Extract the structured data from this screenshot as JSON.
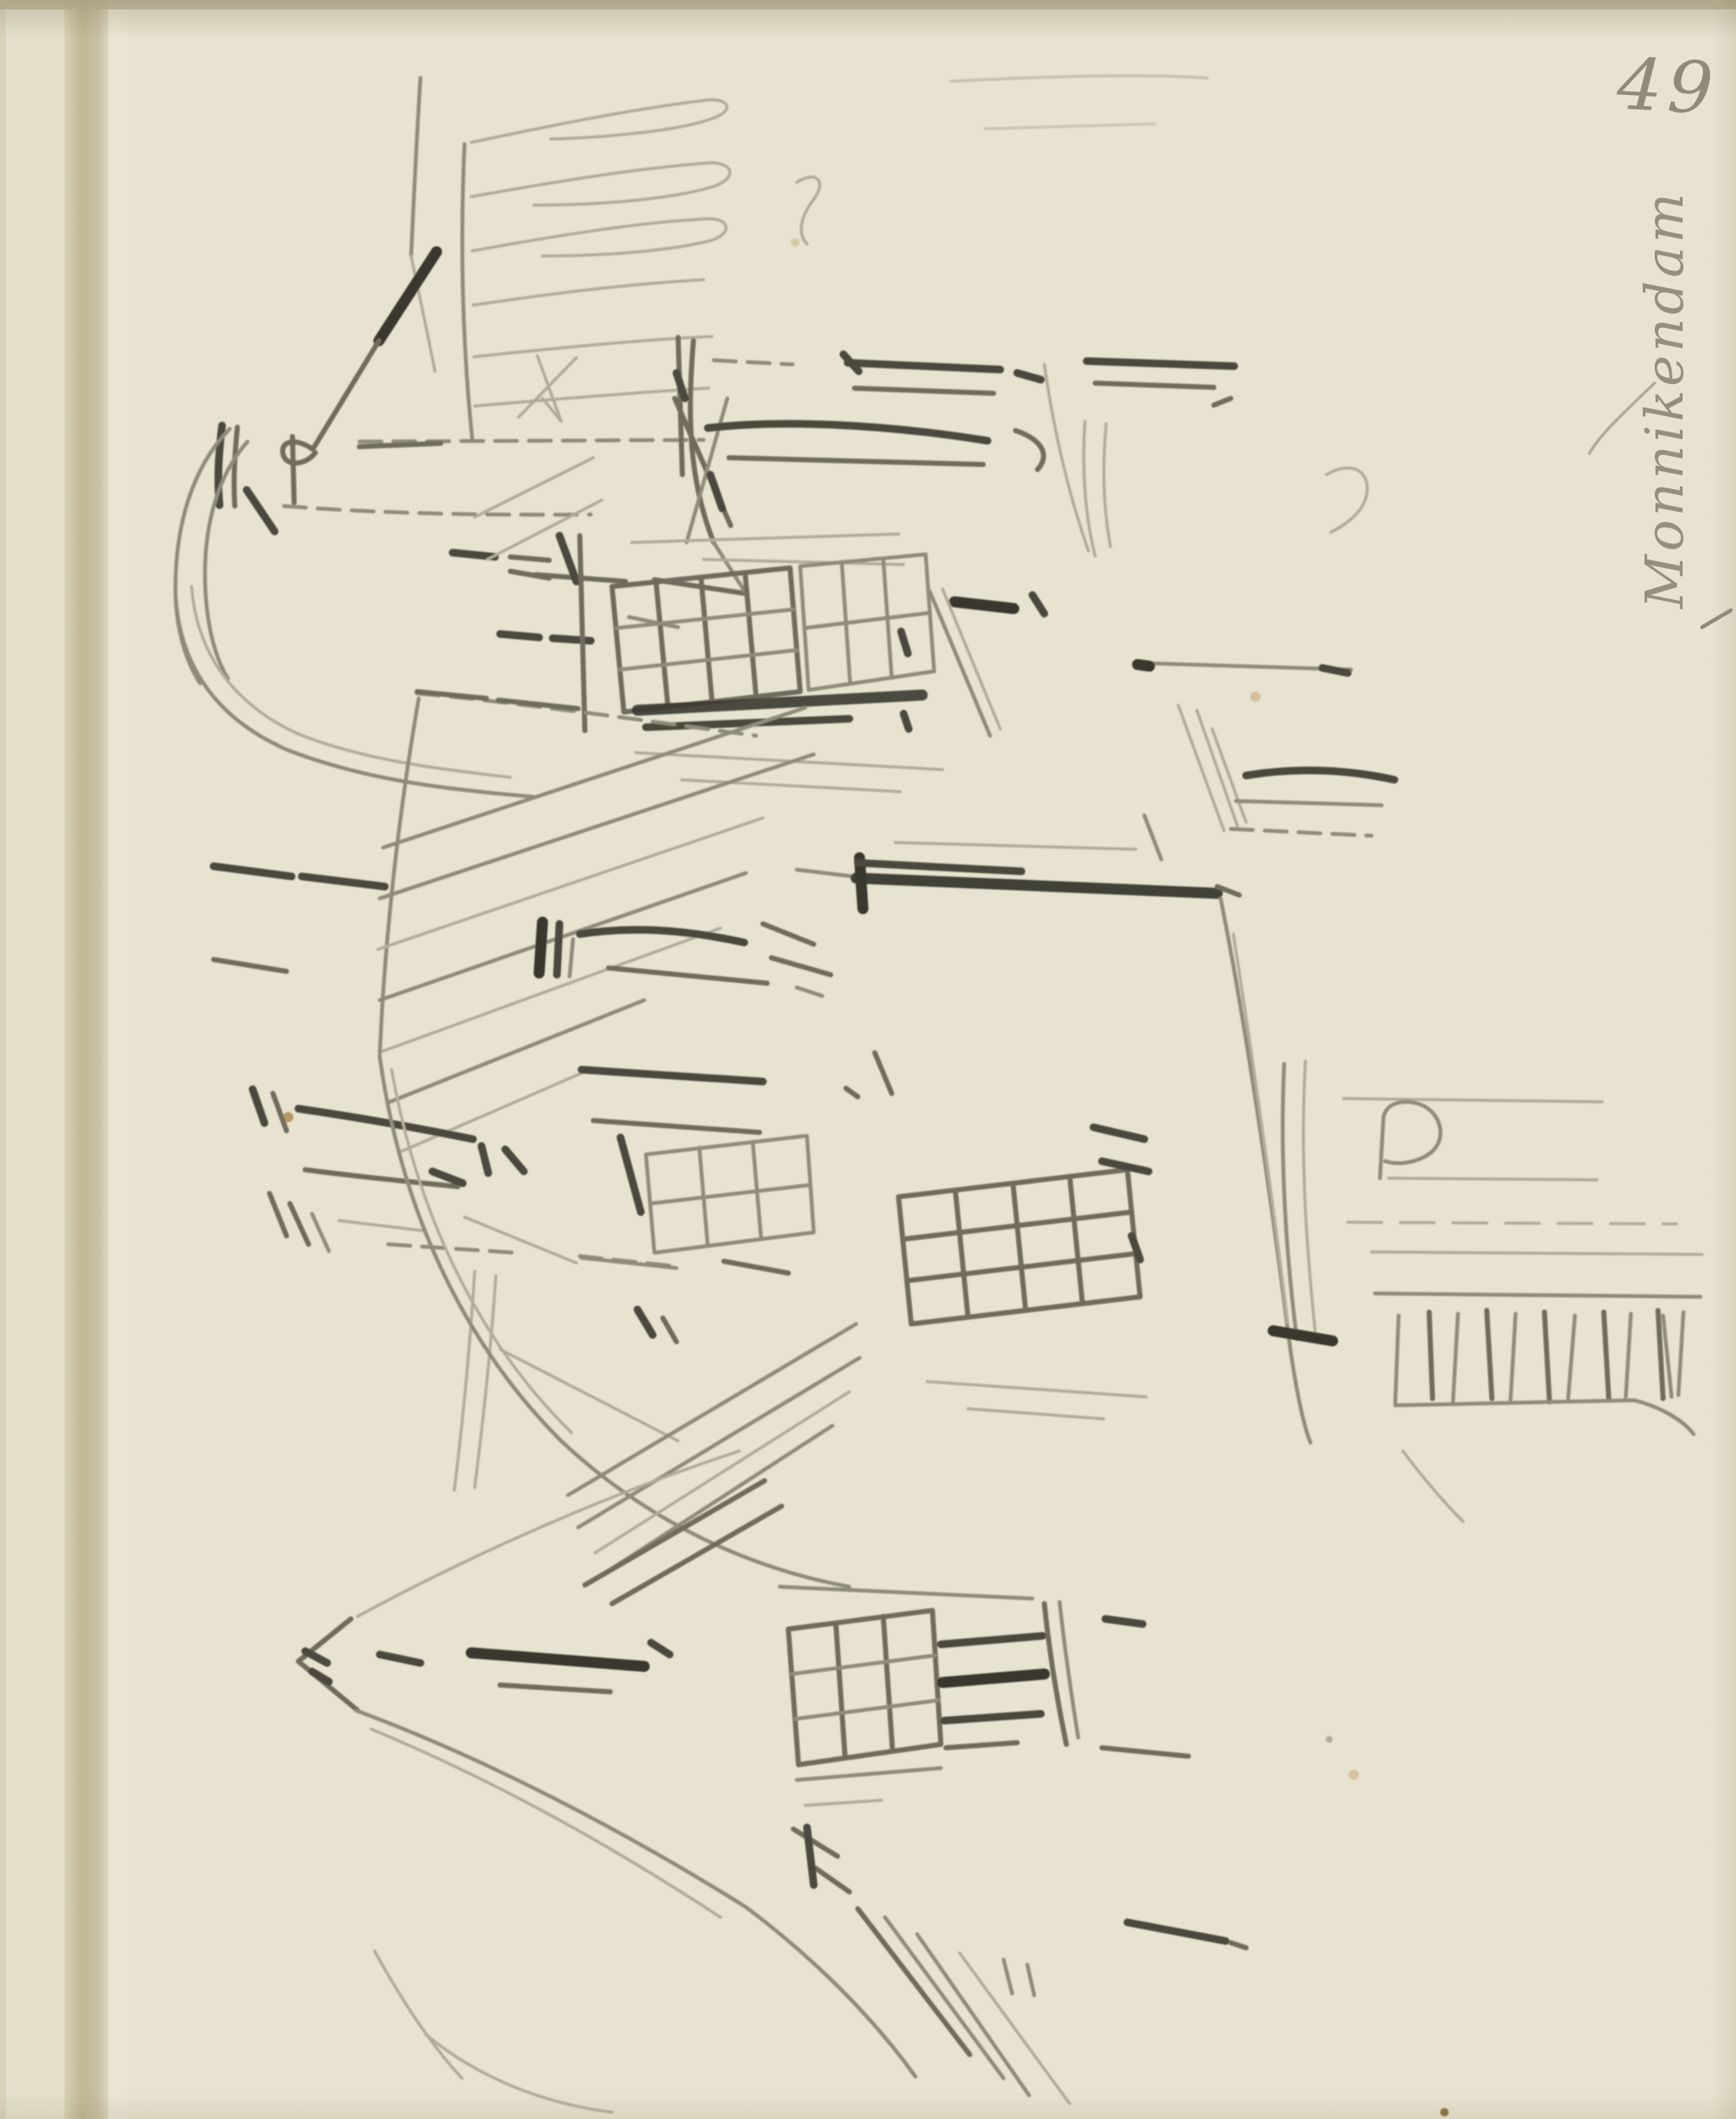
{
  "artwork": {
    "page_number": "49",
    "inscription": "Monnikendam"
  },
  "colors": {
    "paper": "#ece8d6",
    "page_edge": "#e9e5d1",
    "page_edge_rim": "#ded8c2",
    "gutter_dark": "#c3b998",
    "pencil_light": "#b2ad9b",
    "pencil_medium": "#8f8b7a",
    "pencil_strong": "#6e6b5c",
    "pencil_dark": "#47453a",
    "pencil_black": "#34332b",
    "handwriting": "#7e7b6c",
    "foxing": "#c2995c"
  }
}
